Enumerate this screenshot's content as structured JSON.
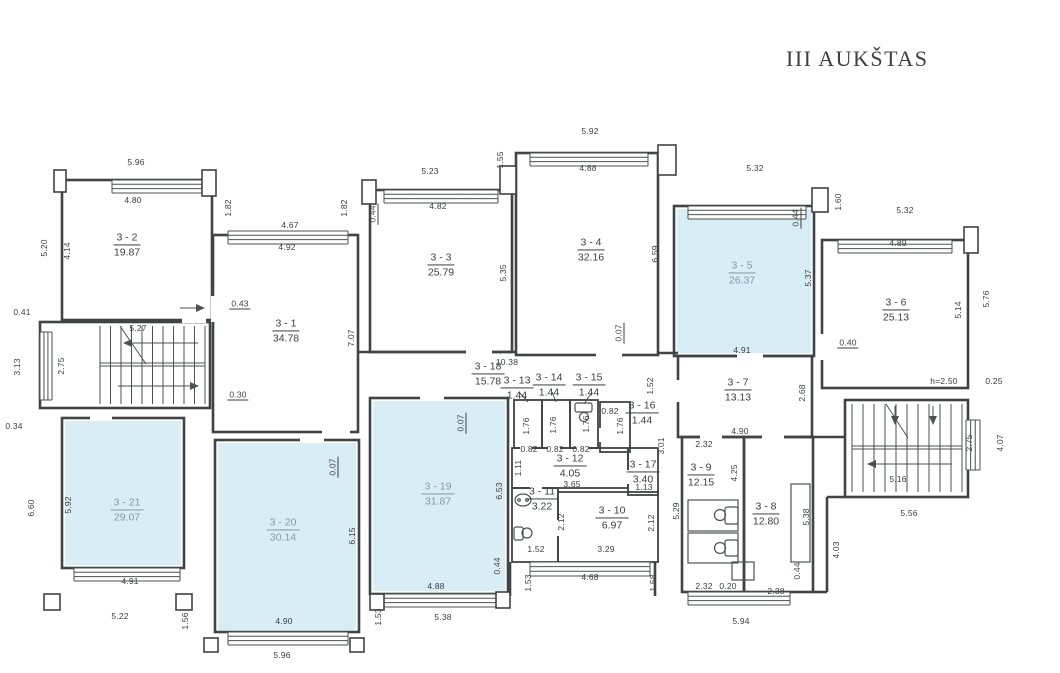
{
  "title": "III AUKŠTAS",
  "colors": {
    "highlight": "#d9edf6",
    "wall": "#3f4444",
    "thin": "#4a5252",
    "text": "#3c4040",
    "muted": "#8598a9"
  },
  "rooms": [
    {
      "name": "3 - 1",
      "area": "34.78",
      "x": 286,
      "y": 331,
      "hl": false
    },
    {
      "name": "3 - 2",
      "area": "19.87",
      "x": 127,
      "y": 245,
      "hl": false
    },
    {
      "name": "3 - 3",
      "area": "25.79",
      "x": 441,
      "y": 265,
      "hl": false
    },
    {
      "name": "3 - 4",
      "area": "32.16",
      "x": 591,
      "y": 250,
      "hl": false
    },
    {
      "name": "3 - 5",
      "area": "26.37",
      "x": 742,
      "y": 273,
      "hl": true
    },
    {
      "name": "3 - 6",
      "area": "25.13",
      "x": 896,
      "y": 310,
      "hl": false
    },
    {
      "name": "3 - 7",
      "area": "13.13",
      "x": 738,
      "y": 390,
      "hl": false
    },
    {
      "name": "3 - 8",
      "area": "12.80",
      "x": 766,
      "y": 514,
      "hl": false
    },
    {
      "name": "3 - 9",
      "area": "12.15",
      "x": 701,
      "y": 475,
      "hl": false
    },
    {
      "name": "3 - 10",
      "area": "6.97",
      "x": 612,
      "y": 518,
      "hl": false
    },
    {
      "name": "3 - 11",
      "area": "3.22",
      "x": 542,
      "y": 499,
      "hl": false
    },
    {
      "name": "3 - 12",
      "area": "4.05",
      "x": 570,
      "y": 466,
      "hl": false
    },
    {
      "name": "3 - 13",
      "area": "1.44",
      "x": 517,
      "y": 388,
      "hl": false
    },
    {
      "name": "3 - 14",
      "area": "1.44",
      "x": 549,
      "y": 385,
      "hl": false
    },
    {
      "name": "3 - 15",
      "area": "1.44",
      "x": 589,
      "y": 385,
      "hl": false
    },
    {
      "name": "3 - 16",
      "area": "1.44",
      "x": 642,
      "y": 413,
      "hl": false
    },
    {
      "name": "3 - 17",
      "area": "3.40",
      "x": 643,
      "y": 472,
      "hl": false
    },
    {
      "name": "3 - 18",
      "area": "15.78",
      "x": 488,
      "y": 374,
      "hl": false
    },
    {
      "name": "3 - 19",
      "area": "31.87",
      "x": 438,
      "y": 494,
      "hl": true
    },
    {
      "name": "3 - 20",
      "area": "30.14",
      "x": 283,
      "y": 530,
      "hl": true
    },
    {
      "name": "3 - 21",
      "area": "29.07",
      "x": 127,
      "y": 510,
      "hl": true
    }
  ],
  "dims": [
    {
      "t": "5.96",
      "x": 136,
      "y": 162
    },
    {
      "t": "4.80",
      "x": 133,
      "y": 200
    },
    {
      "t": "4.67",
      "x": 290,
      "y": 225
    },
    {
      "t": "4.92",
      "x": 287,
      "y": 247
    },
    {
      "t": "5.23",
      "x": 430,
      "y": 171
    },
    {
      "t": "4.82",
      "x": 438,
      "y": 206
    },
    {
      "t": "5.92",
      "x": 590,
      "y": 131
    },
    {
      "t": "4.88",
      "x": 588,
      "y": 168
    },
    {
      "t": "5.32",
      "x": 755,
      "y": 168
    },
    {
      "t": "5.32",
      "x": 905,
      "y": 210
    },
    {
      "t": "4.89",
      "x": 898,
      "y": 243
    },
    {
      "t": "5.27",
      "x": 138,
      "y": 328
    },
    {
      "t": "0.41",
      "x": 22,
      "y": 312
    },
    {
      "t": "0.34",
      "x": 14,
      "y": 426
    },
    {
      "t": "0.43",
      "x": 240,
      "y": 304,
      "u": 1
    },
    {
      "t": "0.30",
      "x": 238,
      "y": 395,
      "u": 1
    },
    {
      "t": "0.40",
      "x": 848,
      "y": 343,
      "u": 1
    },
    {
      "t": "h=2.50",
      "x": 944,
      "y": 381
    },
    {
      "t": "0.25",
      "x": 994,
      "y": 381
    },
    {
      "t": "10.38",
      "x": 507,
      "y": 362
    },
    {
      "t": "4.91",
      "x": 742,
      "y": 350
    },
    {
      "t": "4.90",
      "x": 740,
      "y": 431
    },
    {
      "t": "2.32",
      "x": 704,
      "y": 444
    },
    {
      "t": "0.82",
      "x": 610,
      "y": 411
    },
    {
      "t": "0.82",
      "x": 529,
      "y": 449
    },
    {
      "t": "0.82",
      "x": 555,
      "y": 449
    },
    {
      "t": "0.82",
      "x": 581,
      "y": 449
    },
    {
      "t": "3.65",
      "x": 572,
      "y": 484
    },
    {
      "t": "1.13",
      "x": 644,
      "y": 487
    },
    {
      "t": "1.52",
      "x": 536,
      "y": 549
    },
    {
      "t": "3.29",
      "x": 606,
      "y": 549
    },
    {
      "t": "4.68",
      "x": 590,
      "y": 577
    },
    {
      "t": "2.32",
      "x": 704,
      "y": 586
    },
    {
      "t": "0.20",
      "x": 728,
      "y": 586
    },
    {
      "t": "2.38",
      "x": 776,
      "y": 591
    },
    {
      "t": "5.94",
      "x": 741,
      "y": 621
    },
    {
      "t": "5.56",
      "x": 909,
      "y": 513
    },
    {
      "t": "5.16",
      "x": 898,
      "y": 479
    },
    {
      "t": "4.91",
      "x": 130,
      "y": 581
    },
    {
      "t": "5.22",
      "x": 120,
      "y": 616
    },
    {
      "t": "4.90",
      "x": 284,
      "y": 621
    },
    {
      "t": "5.96",
      "x": 282,
      "y": 655
    },
    {
      "t": "4.88",
      "x": 436,
      "y": 586
    },
    {
      "t": "5.38",
      "x": 443,
      "y": 617
    },
    {
      "t": "5.20",
      "x": 44,
      "y": 248,
      "r": 1
    },
    {
      "t": "4.14",
      "x": 67,
      "y": 251,
      "r": 1
    },
    {
      "t": "3.13",
      "x": 17,
      "y": 367,
      "r": 1
    },
    {
      "t": "2.75",
      "x": 61,
      "y": 366,
      "r": 1
    },
    {
      "t": "1.82",
      "x": 228,
      "y": 208,
      "r": 1
    },
    {
      "t": "1.82",
      "x": 344,
      "y": 208,
      "r": 1
    },
    {
      "t": "0.44",
      "x": 373,
      "y": 214,
      "r": 1,
      "u": 1
    },
    {
      "t": "5.35",
      "x": 503,
      "y": 273,
      "r": 1
    },
    {
      "t": "7.07",
      "x": 351,
      "y": 338,
      "r": 1
    },
    {
      "t": "1.55",
      "x": 500,
      "y": 160,
      "r": 1
    },
    {
      "t": "6.59",
      "x": 655,
      "y": 254,
      "r": 1
    },
    {
      "t": "0.44",
      "x": 796,
      "y": 218,
      "r": 1,
      "u": 1
    },
    {
      "t": "1.60",
      "x": 838,
      "y": 202,
      "r": 1
    },
    {
      "t": "5.37",
      "x": 808,
      "y": 278,
      "r": 1
    },
    {
      "t": "5.14",
      "x": 958,
      "y": 310,
      "r": 1
    },
    {
      "t": "5.76",
      "x": 986,
      "y": 299,
      "r": 1
    },
    {
      "t": "0.07",
      "x": 619,
      "y": 333,
      "r": 1,
      "u": 1
    },
    {
      "t": "1.52",
      "x": 650,
      "y": 386,
      "r": 1
    },
    {
      "t": "2.68",
      "x": 802,
      "y": 393,
      "r": 1
    },
    {
      "t": "3.01",
      "x": 661,
      "y": 446,
      "r": 1
    },
    {
      "t": "1.76",
      "x": 526,
      "y": 426,
      "r": 1
    },
    {
      "t": "1.76",
      "x": 553,
      "y": 425,
      "r": 1
    },
    {
      "t": "1.76",
      "x": 586,
      "y": 424,
      "r": 1
    },
    {
      "t": "1.76",
      "x": 620,
      "y": 426,
      "r": 1
    },
    {
      "t": "1.11",
      "x": 518,
      "y": 468,
      "r": 1
    },
    {
      "t": "2.12",
      "x": 561,
      "y": 522,
      "r": 1
    },
    {
      "t": "2.12",
      "x": 651,
      "y": 523,
      "r": 1
    },
    {
      "t": "5.29",
      "x": 676,
      "y": 511,
      "r": 1
    },
    {
      "t": "4.25",
      "x": 734,
      "y": 473,
      "r": 1
    },
    {
      "t": "5.38",
      "x": 806,
      "y": 517,
      "r": 1
    },
    {
      "t": "0.44",
      "x": 797,
      "y": 571,
      "r": 1
    },
    {
      "t": "4.03",
      "x": 836,
      "y": 550,
      "r": 1
    },
    {
      "t": "1.53",
      "x": 528,
      "y": 583,
      "r": 1
    },
    {
      "t": "1.58",
      "x": 653,
      "y": 583,
      "r": 1
    },
    {
      "t": "1.53",
      "x": 378,
      "y": 617,
      "r": 1
    },
    {
      "t": "1.56",
      "x": 185,
      "y": 621,
      "r": 1
    },
    {
      "t": "5.92",
      "x": 68,
      "y": 505,
      "r": 1
    },
    {
      "t": "6.60",
      "x": 31,
      "y": 508,
      "r": 1
    },
    {
      "t": "6.15",
      "x": 352,
      "y": 536,
      "r": 1
    },
    {
      "t": "0.07",
      "x": 333,
      "y": 467,
      "r": 1,
      "u": 1
    },
    {
      "t": "0.07",
      "x": 461,
      "y": 423,
      "r": 1,
      "u": 1
    },
    {
      "t": "6.53",
      "x": 499,
      "y": 491,
      "r": 1
    },
    {
      "t": "0.44",
      "x": 497,
      "y": 566,
      "r": 1
    },
    {
      "t": "2.75",
      "x": 969,
      "y": 443,
      "r": 1
    },
    {
      "t": "4.07",
      "x": 1000,
      "y": 443,
      "r": 1
    }
  ]
}
